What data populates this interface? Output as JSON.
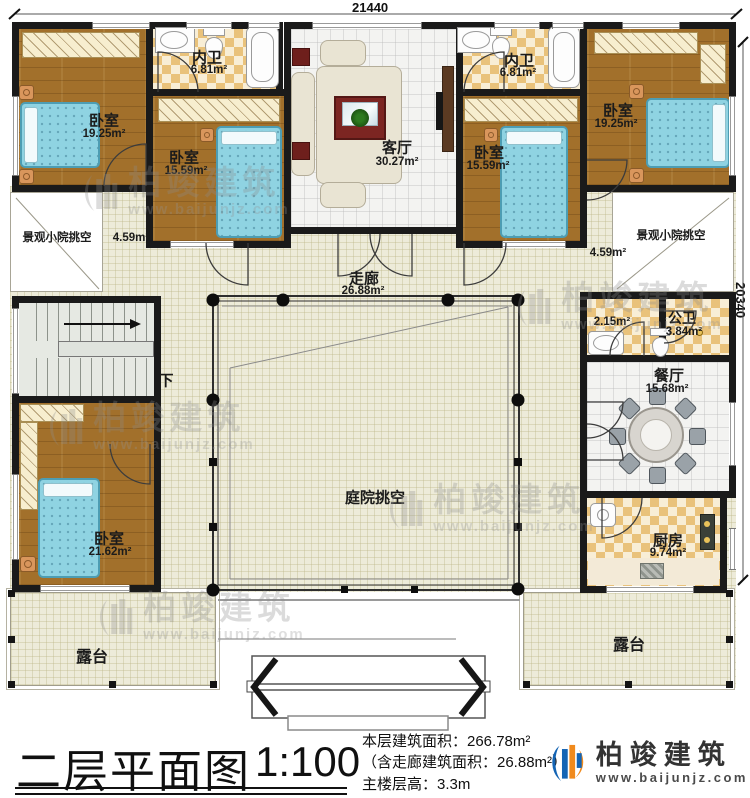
{
  "dims": {
    "top": "21440",
    "right": "20340"
  },
  "rooms": {
    "bedroom_tl": {
      "name": "卧室",
      "area": "19.25m²"
    },
    "bath_l": {
      "name": "内卫",
      "area": "6.81m²"
    },
    "bedroom_ml": {
      "name": "卧室",
      "area": "15.59m²"
    },
    "living": {
      "name": "客厅",
      "area": "30.27m²"
    },
    "bath_r": {
      "name": "内卫",
      "area": "6.81m²"
    },
    "bedroom_mr": {
      "name": "卧室",
      "area": "15.59m²"
    },
    "bedroom_tr": {
      "name": "卧室",
      "area": "19.25m²"
    },
    "void_l": {
      "name": "景观小院挑空",
      "area": "4.59m²"
    },
    "void_r": {
      "name": "景观小院挑空",
      "area": "4.59m²"
    },
    "corridor": {
      "name": "走廊",
      "area": "26.88m²"
    },
    "stairs": {
      "down": "下"
    },
    "bedroom_bl": {
      "name": "卧室",
      "area": "21.62m²"
    },
    "courtyard": {
      "name": "庭院挑空"
    },
    "wash": {
      "area": "2.15m²"
    },
    "public_bath": {
      "name": "公卫",
      "area": "3.84m²"
    },
    "dining": {
      "name": "餐厅",
      "area": "15.68m²"
    },
    "kitchen": {
      "name": "厨房",
      "area": "9.74m²"
    },
    "terrace_l": {
      "name": "露台"
    },
    "terrace_r": {
      "name": "露台"
    }
  },
  "titleblock": {
    "title": "二层平面图",
    "scale": "1:100",
    "area_main": "本层建筑面积：266.78m²",
    "area_sub": "（含走廊建筑面积：26.88m²）",
    "floor_height": "主楼层高：3.3m"
  },
  "brand": {
    "name": "柏竣建筑",
    "url": "www.baijunjz.com"
  },
  "colors": {
    "wall": "#1a1a1a",
    "wood": "#a2702b",
    "checker": "#e9c27b",
    "bed": "#8fd3e2",
    "brand_blue": "#1464b4",
    "brand_orange": "#f08a1d"
  }
}
